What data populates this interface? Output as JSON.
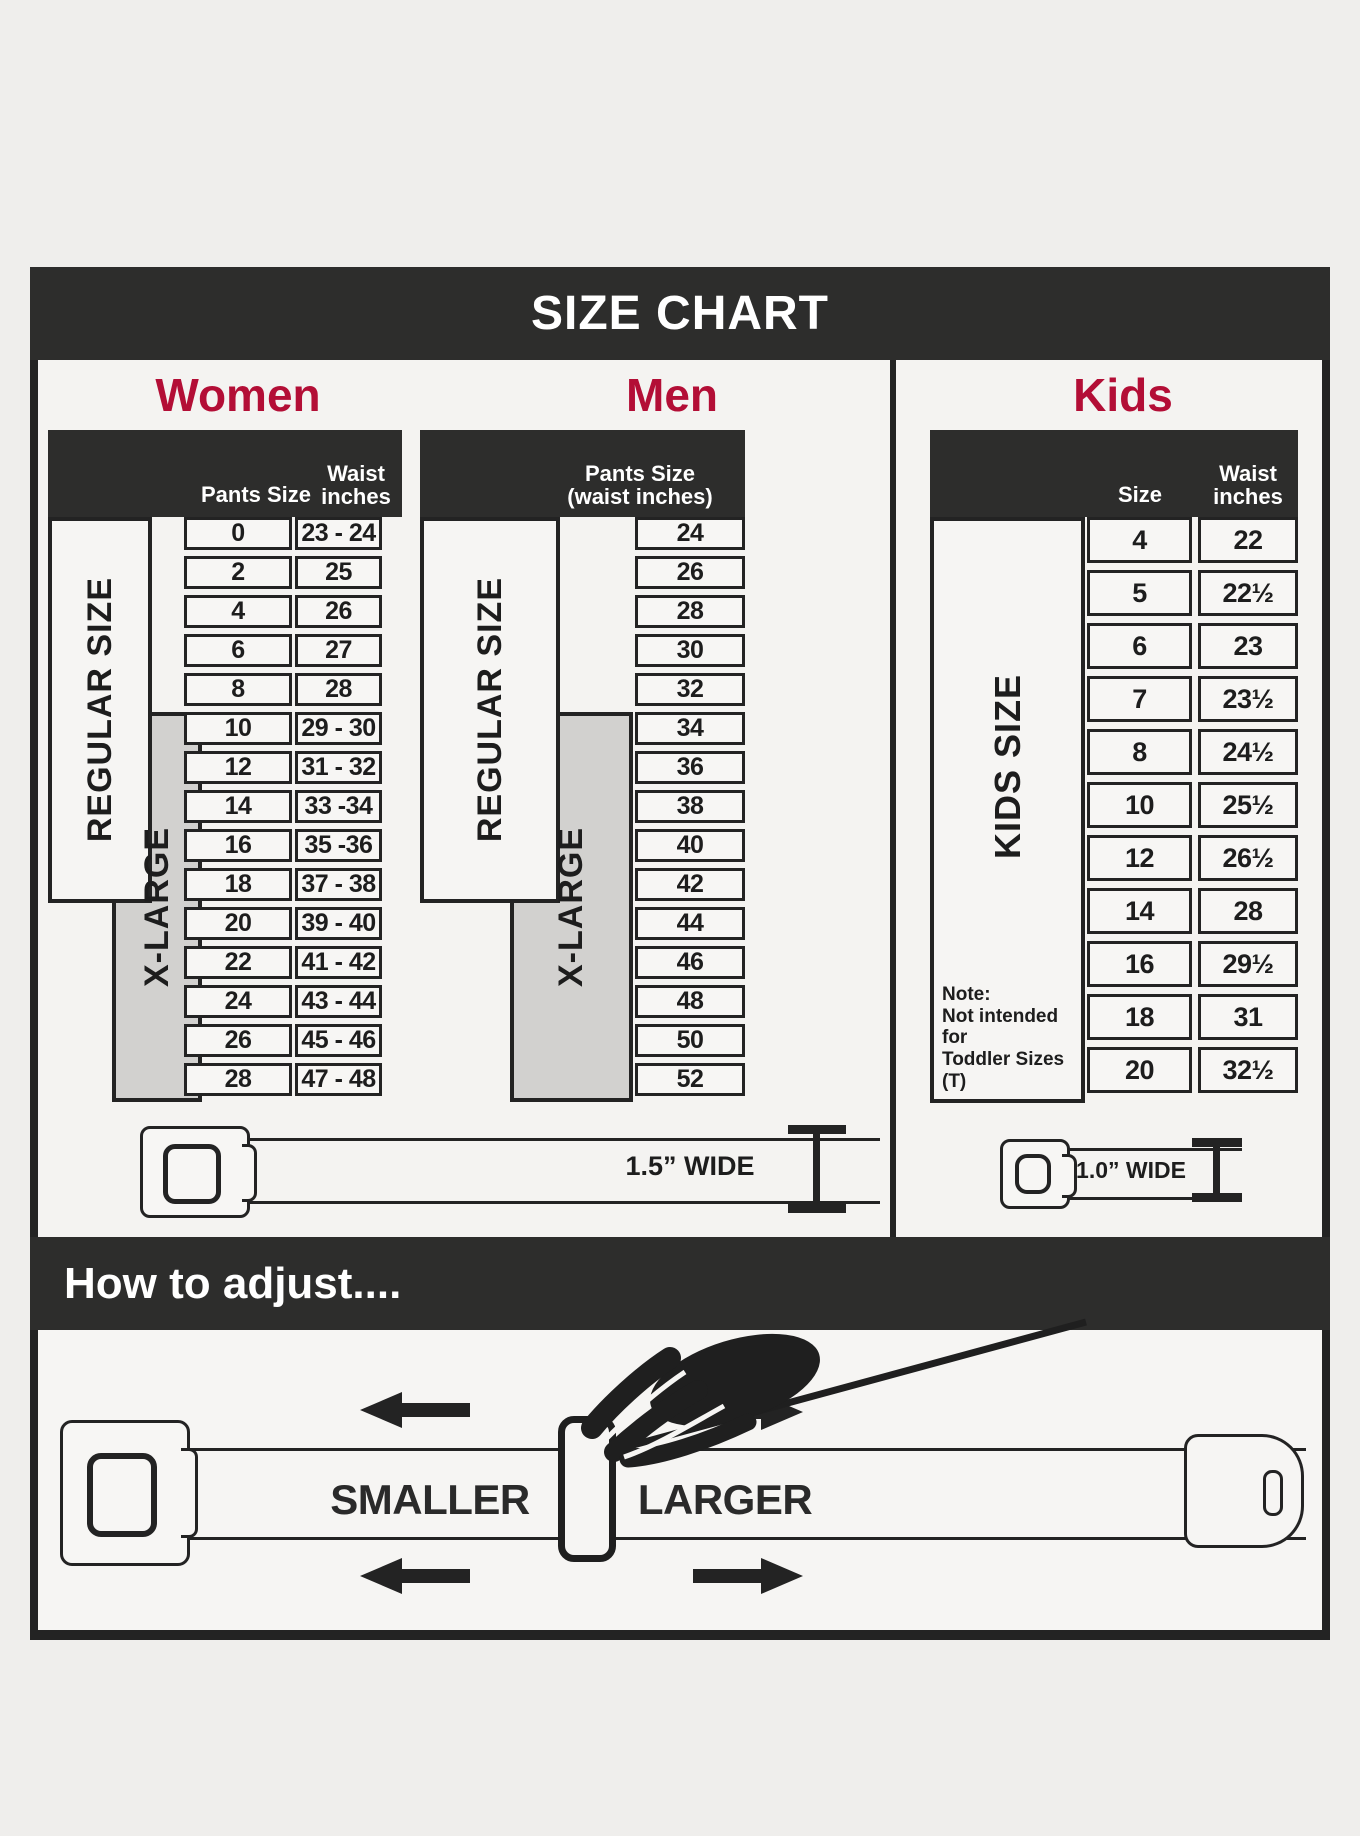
{
  "title": "SIZE CHART",
  "colors": {
    "accent_red": "#b30e36",
    "bar_dark": "#2d2d2c",
    "line_dark": "#232323",
    "panel_bg": "#f4f3f1",
    "xlarge_gray": "#d2d1cf"
  },
  "women": {
    "heading": "Women",
    "col_size": "Pants Size",
    "col_waist_1": "Waist",
    "col_waist_2": "inches",
    "regular_label": "REGULAR SIZE",
    "xlarge_label": "X-LARGE",
    "belt_width": "1.5” WIDE",
    "rows": [
      {
        "size": "0",
        "waist": "23 - 24"
      },
      {
        "size": "2",
        "waist": "25"
      },
      {
        "size": "4",
        "waist": "26"
      },
      {
        "size": "6",
        "waist": "27"
      },
      {
        "size": "8",
        "waist": "28"
      },
      {
        "size": "10",
        "waist": "29 - 30"
      },
      {
        "size": "12",
        "waist": "31 - 32"
      },
      {
        "size": "14",
        "waist": "33 -34"
      },
      {
        "size": "16",
        "waist": "35 -36"
      },
      {
        "size": "18",
        "waist": "37 - 38"
      },
      {
        "size": "20",
        "waist": "39 - 40"
      },
      {
        "size": "22",
        "waist": "41 - 42"
      },
      {
        "size": "24",
        "waist": "43 - 44"
      },
      {
        "size": "26",
        "waist": "45 - 46"
      },
      {
        "size": "28",
        "waist": "47 - 48"
      }
    ]
  },
  "men": {
    "heading": "Men",
    "header_1": "Pants Size",
    "header_2": "(waist inches)",
    "regular_label": "REGULAR SIZE",
    "xlarge_label": "X-LARGE",
    "rows": [
      "24",
      "26",
      "28",
      "30",
      "32",
      "34",
      "36",
      "38",
      "40",
      "42",
      "44",
      "46",
      "48",
      "50",
      "52"
    ]
  },
  "kids": {
    "heading": "Kids",
    "col_size": "Size",
    "col_waist_1": "Waist",
    "col_waist_2": "inches",
    "side_label": "KIDS SIZE",
    "note_title": "Note:",
    "note_line2": "Not intended for",
    "note_line3": "Toddler Sizes (T)",
    "belt_width": "1.0” WIDE",
    "rows": [
      {
        "size": "4",
        "waist": "22"
      },
      {
        "size": "5",
        "waist": "22½"
      },
      {
        "size": "6",
        "waist": "23"
      },
      {
        "size": "7",
        "waist": "23½"
      },
      {
        "size": "8",
        "waist": "24½"
      },
      {
        "size": "10",
        "waist": "25½"
      },
      {
        "size": "12",
        "waist": "26½"
      },
      {
        "size": "14",
        "waist": "28"
      },
      {
        "size": "16",
        "waist": "29½"
      },
      {
        "size": "18",
        "waist": "31"
      },
      {
        "size": "20",
        "waist": "32½"
      }
    ]
  },
  "adjust": {
    "heading": "How to adjust....",
    "smaller": "SMALLER",
    "larger": "LARGER"
  },
  "chart_data": [
    {
      "type": "table",
      "title": "Women",
      "columns": [
        "Pants Size",
        "Waist inches"
      ],
      "rows": [
        [
          "0",
          "23 - 24"
        ],
        [
          "2",
          "25"
        ],
        [
          "4",
          "26"
        ],
        [
          "6",
          "27"
        ],
        [
          "8",
          "28"
        ],
        [
          "10",
          "29 - 30"
        ],
        [
          "12",
          "31 - 32"
        ],
        [
          "14",
          "33 -34"
        ],
        [
          "16",
          "35 -36"
        ],
        [
          "18",
          "37 - 38"
        ],
        [
          "20",
          "39 - 40"
        ],
        [
          "22",
          "41 - 42"
        ],
        [
          "24",
          "43 - 44"
        ],
        [
          "26",
          "45 - 46"
        ],
        [
          "28",
          "47 - 48"
        ]
      ],
      "row_groups": {
        "REGULAR SIZE": [
          "0",
          "18"
        ],
        "X-LARGE": [
          "10",
          "28"
        ]
      },
      "belt_width": "1.5” WIDE"
    },
    {
      "type": "table",
      "title": "Men",
      "columns": [
        "Pants Size (waist inches)"
      ],
      "rows": [
        [
          "24"
        ],
        [
          "26"
        ],
        [
          "28"
        ],
        [
          "30"
        ],
        [
          "32"
        ],
        [
          "34"
        ],
        [
          "36"
        ],
        [
          "38"
        ],
        [
          "40"
        ],
        [
          "42"
        ],
        [
          "44"
        ],
        [
          "46"
        ],
        [
          "48"
        ],
        [
          "50"
        ],
        [
          "52"
        ]
      ],
      "row_groups": {
        "REGULAR SIZE": [
          "24",
          "42"
        ],
        "X-LARGE": [
          "34",
          "52"
        ]
      },
      "belt_width": "1.5” WIDE"
    },
    {
      "type": "table",
      "title": "Kids",
      "columns": [
        "Size",
        "Waist inches"
      ],
      "rows": [
        [
          "4",
          "22"
        ],
        [
          "5",
          "22½"
        ],
        [
          "6",
          "23"
        ],
        [
          "7",
          "23½"
        ],
        [
          "8",
          "24½"
        ],
        [
          "10",
          "25½"
        ],
        [
          "12",
          "26½"
        ],
        [
          "14",
          "28"
        ],
        [
          "16",
          "29½"
        ],
        [
          "18",
          "31"
        ],
        [
          "20",
          "32½"
        ]
      ],
      "row_groups": {
        "KIDS SIZE": [
          "4",
          "20"
        ]
      },
      "note": "Note: Not intended for Toddler Sizes (T)",
      "belt_width": "1.0” WIDE"
    }
  ]
}
